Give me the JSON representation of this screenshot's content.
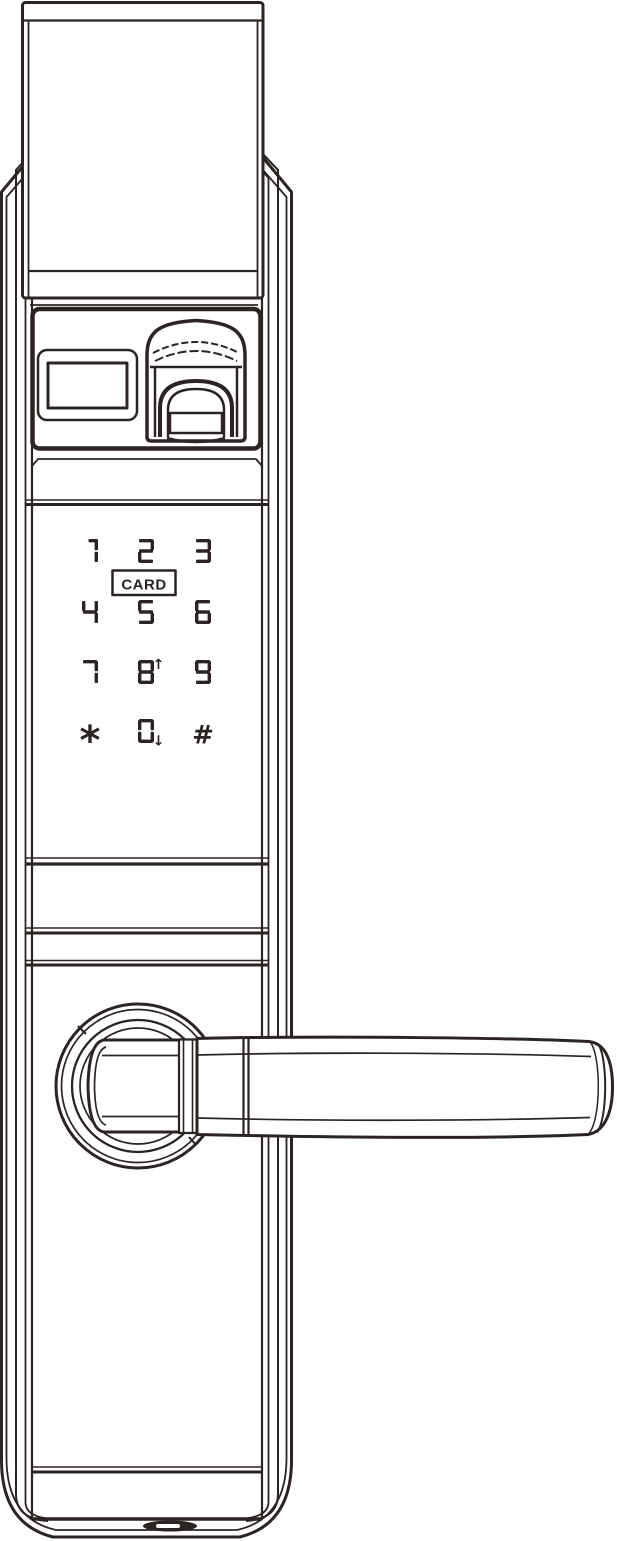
{
  "illustration": {
    "subject": "smart-door-lock-front-view",
    "ink_color": "#2b2422",
    "background_color": "#ffffff"
  },
  "keypad": {
    "card_label": "CARD",
    "layout": [
      [
        "1",
        "2",
        "3"
      ],
      [
        "4",
        "5",
        "6"
      ],
      [
        "7",
        "8",
        "9"
      ],
      [
        "*",
        "0",
        "#"
      ]
    ],
    "keys": [
      {
        "label": "1"
      },
      {
        "label": "2"
      },
      {
        "label": "3"
      },
      {
        "label": "4"
      },
      {
        "label": "5"
      },
      {
        "label": "6"
      },
      {
        "label": "7"
      },
      {
        "label": "8",
        "marker": "↑"
      },
      {
        "label": "9"
      },
      {
        "label": "*"
      },
      {
        "label": "0",
        "marker": "↓"
      },
      {
        "label": "#"
      }
    ]
  }
}
